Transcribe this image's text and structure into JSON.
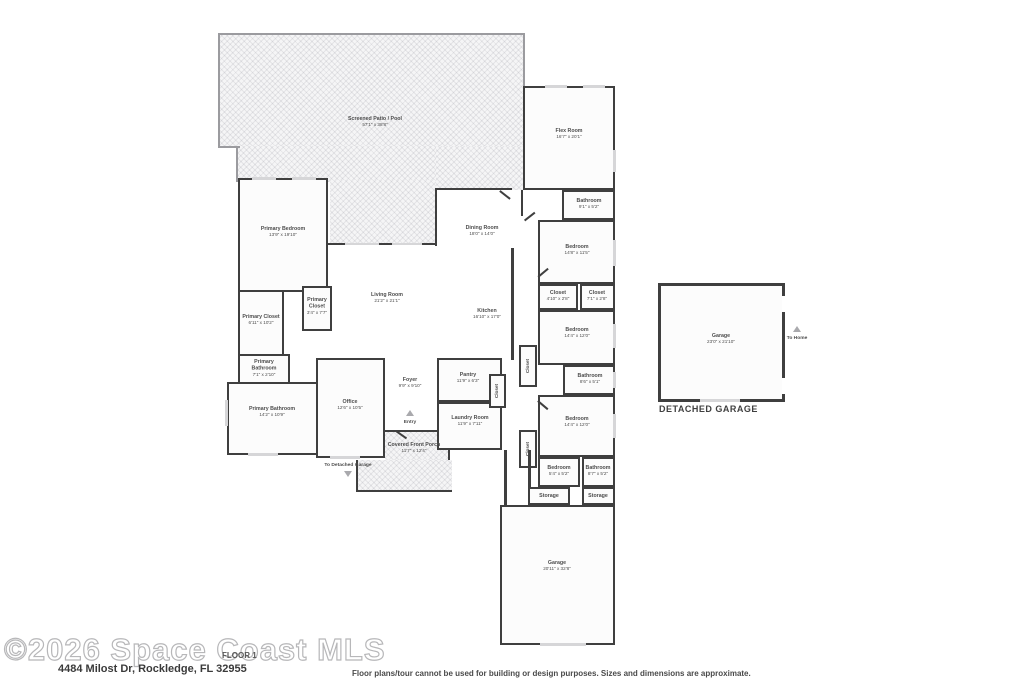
{
  "footer": {
    "watermark": "©2026 Space Coast MLS",
    "floor_label": "FLOOR 1",
    "address": "4484 Milost Dr, Rockledge, FL 32955",
    "disclaimer": "Floor plans/tour cannot be used for building or design purposes. Sizes and dimensions are approximate."
  },
  "annotations": {
    "detached_garage_caption": "DETACHED GARAGE",
    "to_home": "To Home",
    "to_detached_garage": "To Detached Garage",
    "entry": "Entry",
    "closet": "Closet"
  },
  "colors": {
    "wall": "#3f3f3f",
    "screen_wall": "#9b9b9f",
    "room_fill": "#fcfcfc",
    "hatch_fill": "#f5f5f6",
    "label_text": "#4d4d4d",
    "watermark_outline": "#b7b7b9"
  },
  "rooms": {
    "patio": {
      "name": "Screened Patio / Pool",
      "dims": "57'1\" x 38'8\""
    },
    "flex": {
      "name": "Flex Room",
      "dims": "16'7\" x 20'1\""
    },
    "primary_bedroom": {
      "name": "Primary Bedroom",
      "dims": "13'9\" x 19'10\""
    },
    "dining": {
      "name": "Dining Room",
      "dims": "18'0\" x 14'0\""
    },
    "living": {
      "name": "Living Room",
      "dims": "21'2\" x 21'1\""
    },
    "kitchen": {
      "name": "Kitchen",
      "dims": "16'10\" x 17'0\""
    },
    "bathroom1": {
      "name": "Bathroom",
      "dims": "9'1\" x 5'2\""
    },
    "bedroom1": {
      "name": "Bedroom",
      "dims": "14'8\" x 11'5\""
    },
    "closet1": {
      "name": "Closet",
      "dims": "4'10\" x 2'8\""
    },
    "closet2": {
      "name": "Closet",
      "dims": "7'1\" x 2'8\""
    },
    "bedroom2": {
      "name": "Bedroom",
      "dims": "14'4\" x 12'0\""
    },
    "bathroom2": {
      "name": "Bathroom",
      "dims": "8'6\" x 5'1\""
    },
    "bedroom3": {
      "name": "Bedroom",
      "dims": "14'4\" x 12'0\""
    },
    "bedroom4": {
      "name": "Bedroom",
      "dims": "5'4\" x 5'2\""
    },
    "bathroom3": {
      "name": "Bathroom",
      "dims": "8'7\" x 5'2\""
    },
    "storage1": {
      "name": "Storage",
      "dims": ""
    },
    "storage2": {
      "name": "Storage",
      "dims": ""
    },
    "garage_attached": {
      "name": "Garage",
      "dims": "20'11\" x 32'8\""
    },
    "garage_detached": {
      "name": "Garage",
      "dims": "23'0\" x 21'10\""
    },
    "primary_closet1": {
      "name": "Primary Closet",
      "dims": "6'11\" x 10'2\""
    },
    "primary_closet2": {
      "name": "Primary Closet",
      "dims": "3'4\" x 7'7\""
    },
    "primary_bath_sm": {
      "name": "Primary Bathroom",
      "dims": "7'1\" x 2'10\""
    },
    "primary_bath": {
      "name": "Primary Bathroom",
      "dims": "14'2\" x 10'9\""
    },
    "office": {
      "name": "Office",
      "dims": "12'6\" x 10'5\""
    },
    "foyer": {
      "name": "Foyer",
      "dims": "9'9\" x 9'10\""
    },
    "pantry": {
      "name": "Pantry",
      "dims": "11'9\" x 6'3\""
    },
    "laundry": {
      "name": "Laundry Room",
      "dims": "11'9\" x 7'11\""
    },
    "porch": {
      "name": "Covered Front Porch",
      "dims": "11'7\" x 12'4\""
    }
  }
}
